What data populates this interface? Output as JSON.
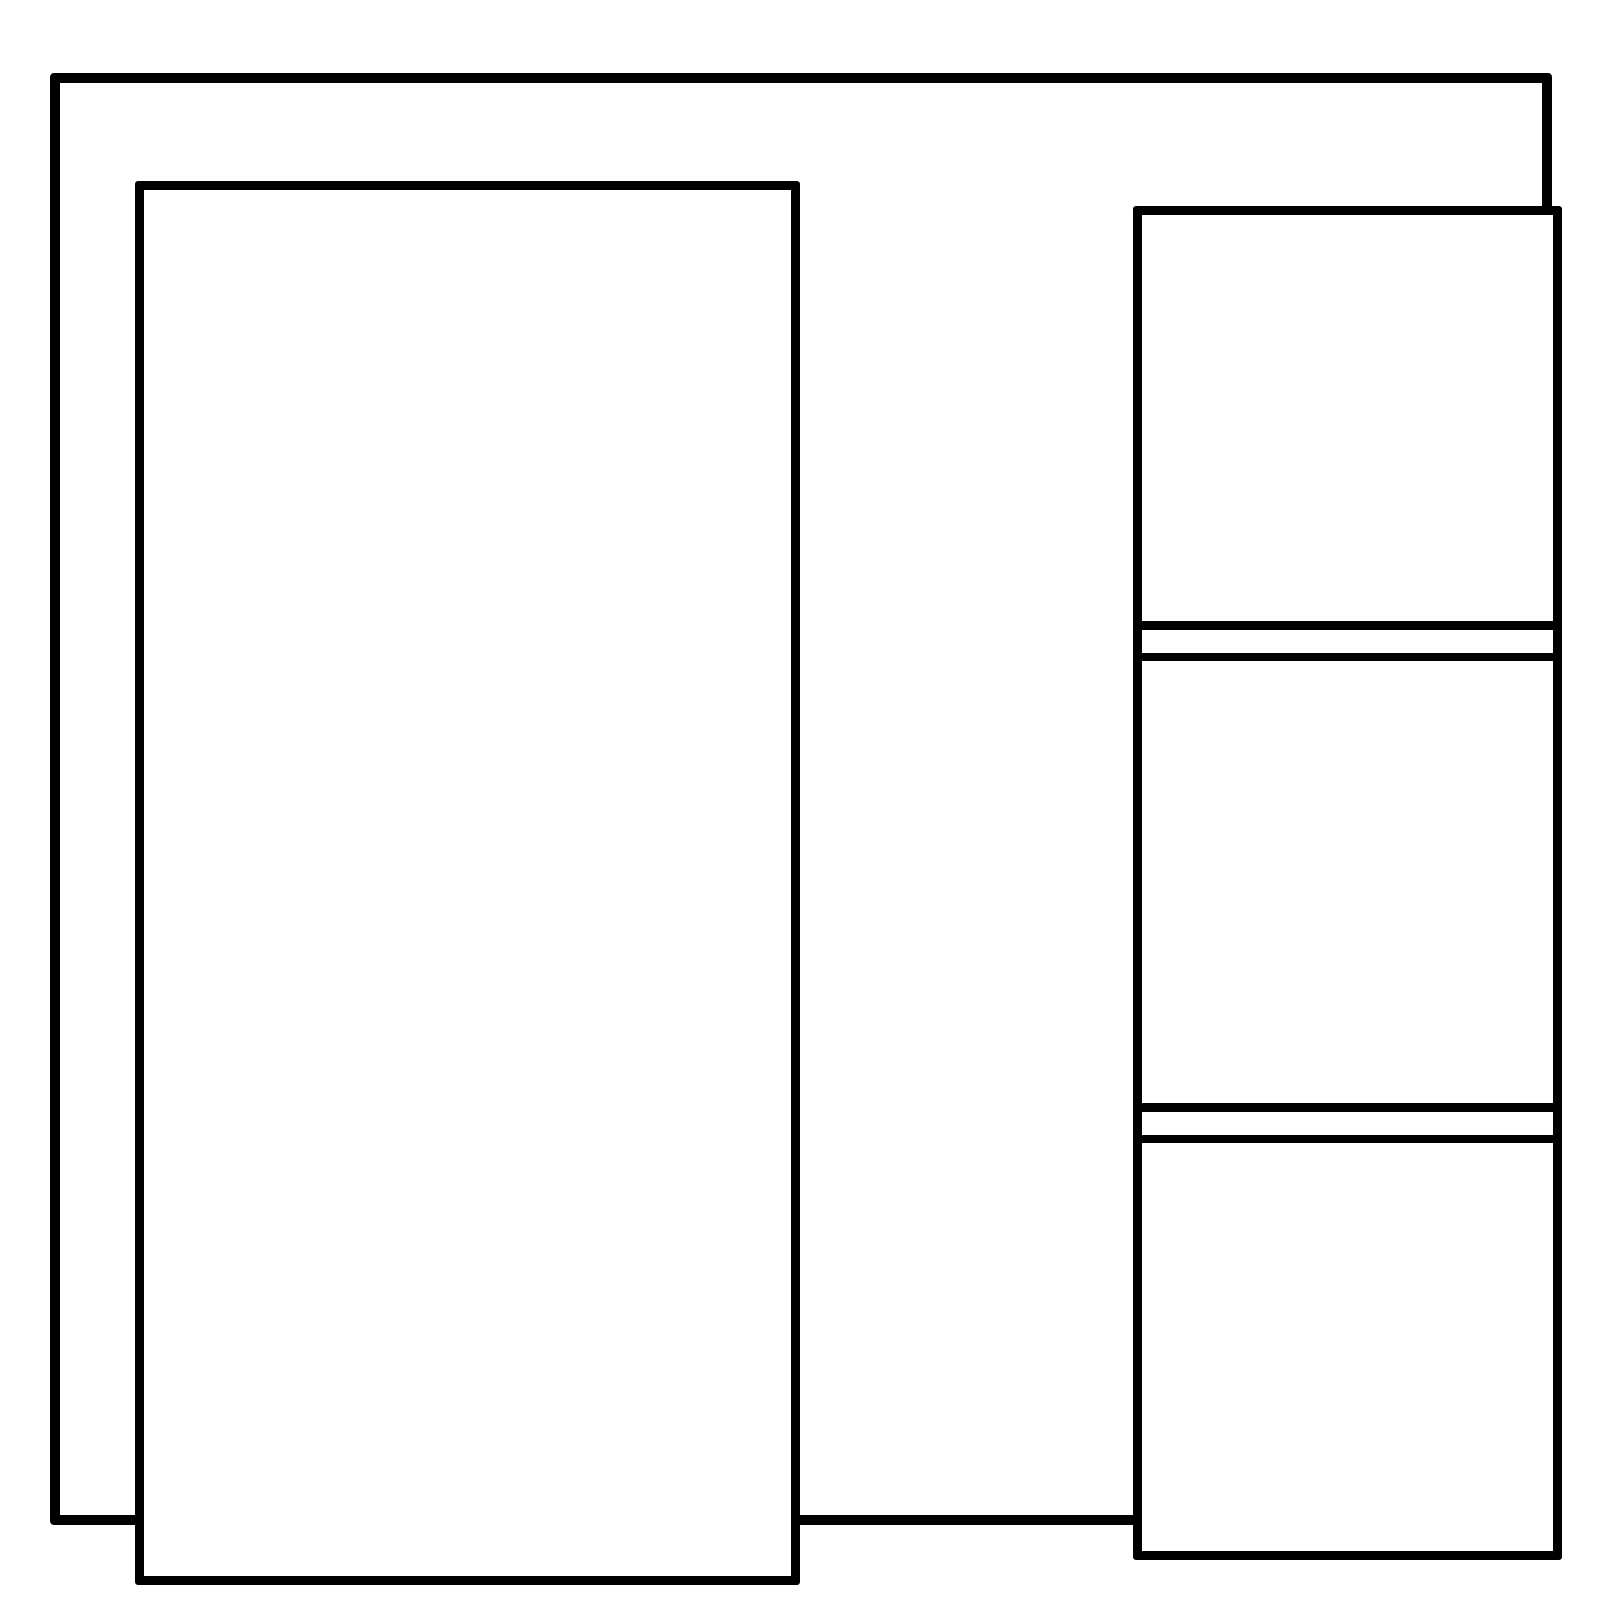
{
  "theme": {
    "bg": "#ffffff",
    "stroke": "#000000"
  },
  "diagram": {
    "description": "Empty wireframe layout: outer frame, tall left panel, right column split into three sections by two thin horizontal separators",
    "left_panel": {
      "content": ""
    },
    "right_column": {
      "section_count": 3,
      "separator_count": 2,
      "sections": [
        {
          "content": ""
        },
        {
          "content": ""
        },
        {
          "content": ""
        }
      ]
    }
  }
}
